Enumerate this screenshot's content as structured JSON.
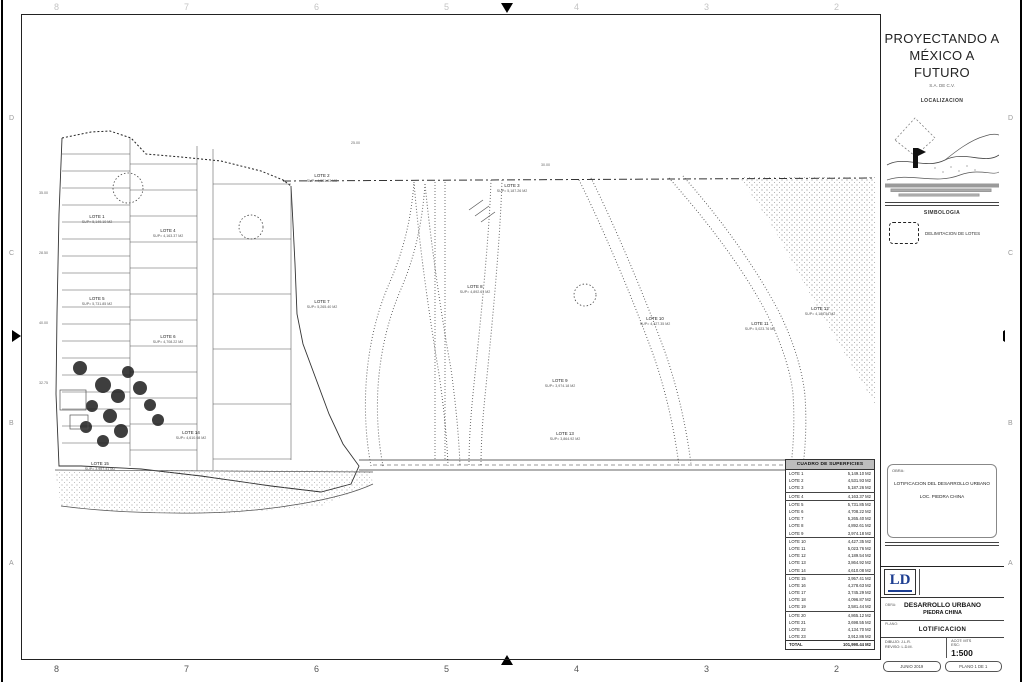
{
  "sheet": {
    "grid_numbers": [
      "8",
      "7",
      "6",
      "5",
      "4",
      "3",
      "2"
    ],
    "side_letters": [
      "D",
      "C",
      "B",
      "A"
    ]
  },
  "titleblock": {
    "company_line1": "PROYECTANDO A",
    "company_line2": "MÉXICO A FUTURO",
    "company_sub": "S.A. DE C.V.",
    "localizacion_title": "LOCALIZACION",
    "simbologia_title": "SIMBOLOGIA",
    "simbologia_item": "DELIMITACION DE LOTES",
    "notes": {
      "obra_label": "OBRA:",
      "line1": "LOTIFICACION DEL DESARROLLO URBANO",
      "line2": "LOC. PIEDRA CHINA"
    },
    "fineprint_lines": [
      "FECHA: MAYO 2019",
      "DIBUJO: ING. J. LOPEZ R.",
      "REVISO: ARQ. L. DIAZ M.",
      "ESCALA: 1:500  ACOT: METROS"
    ],
    "logo_text": "LD",
    "company_info": [
      "LD PROYECTOS Y CONSTRUCCIONES S.A. DE C.V.",
      "AV. JUAREZ No. 12, COL. CENTRO",
      "VILLAHERMOSA, TABASCO",
      "TEL. (993) 123 45 67"
    ],
    "proyecto_label": "OBRA:",
    "project_title1": "DESARROLLO URBANO",
    "project_title2": "PIEDRA CHINA",
    "plano_label": "PLANO:",
    "plano_title": "LOTIFICACION",
    "dibujo_line": "DIBUJO: J.L.R.",
    "reviso_line": "REVISO: L.D.M.",
    "acot_line": "ACOT: MTS",
    "esc_label": "ESC:",
    "esc_value": "1:500",
    "fecha_box": "JUNIO 2019",
    "clave_box": "PLANO 1 DE 1"
  },
  "table": {
    "title": "CUADRO DE SUPERFICIES",
    "unit": "M2",
    "rows": [
      {
        "name": "LOTE 1",
        "area": "5,149.10 M2"
      },
      {
        "name": "LOTE 2",
        "area": "4,531.93 M2"
      },
      {
        "name": "LOTE 3",
        "area": "5,187.26 M2"
      },
      {
        "name": "LOTE 4",
        "area": "4,163.37 M2"
      },
      {
        "name": "LOTE 5",
        "area": "5,731.85 M2"
      },
      {
        "name": "LOTE 6",
        "area": "4,708.22 M2"
      },
      {
        "name": "LOTE 7",
        "area": "5,265.40 M2"
      },
      {
        "name": "LOTE 8",
        "area": "4,892.61 M2"
      },
      {
        "name": "LOTE 9",
        "area": "3,974.18 M2"
      },
      {
        "name": "LOTE 10",
        "area": "4,427.35 M2"
      },
      {
        "name": "LOTE 11",
        "area": "5,023.76 M2"
      },
      {
        "name": "LOTE 12",
        "area": "4,189.54 M2"
      },
      {
        "name": "LOTE 13",
        "area": "3,864.92 M2"
      },
      {
        "name": "LOTE 14",
        "area": "4,610.08 M2"
      },
      {
        "name": "LOTE 15",
        "area": "3,957.41 M2"
      },
      {
        "name": "LOTE 16",
        "area": "4,278.63 M2"
      },
      {
        "name": "LOTE 17",
        "area": "3,745.29 M2"
      },
      {
        "name": "LOTE 18",
        "area": "4,096.87 M2"
      },
      {
        "name": "LOTE 19",
        "area": "3,581.44 M2"
      },
      {
        "name": "LOTE 20",
        "area": "4,865.12 M2"
      },
      {
        "name": "LOTE 21",
        "area": "3,698.55 M2"
      },
      {
        "name": "LOTE 22",
        "area": "4,134.70 M2"
      },
      {
        "name": "LOTE 23",
        "area": "3,912.86 M2"
      },
      {
        "name": "TOTAL",
        "area": "101,990.44 M2"
      }
    ]
  },
  "plan": {
    "sup_prefix": "SUP=",
    "dims": [
      "35.00",
      "28.50",
      "40.00",
      "32.75",
      "25.00",
      "30.00"
    ]
  }
}
